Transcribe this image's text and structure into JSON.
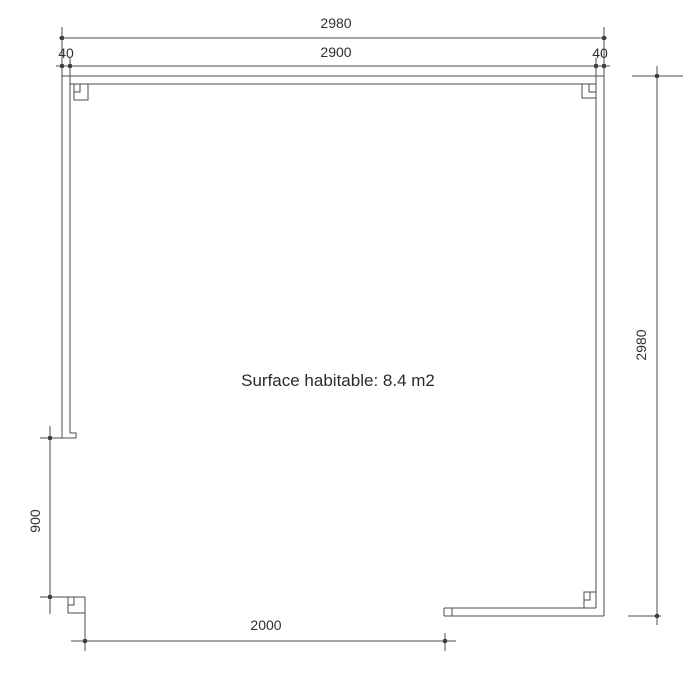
{
  "drawing": {
    "surface_label": "Surface habitable: 8.4 m2",
    "dimensions": {
      "overall_width": "2980",
      "inner_width": "2900",
      "wall_thickness_left": "40",
      "wall_thickness_right": "40",
      "overall_height": "2980",
      "side_opening_height": "900",
      "front_opening_width": "2000"
    },
    "colors": {
      "line": "#4b4b4b",
      "marker_dot": "#3d3d3d",
      "text": "#2f2f2f",
      "background": "#ffffff"
    }
  }
}
